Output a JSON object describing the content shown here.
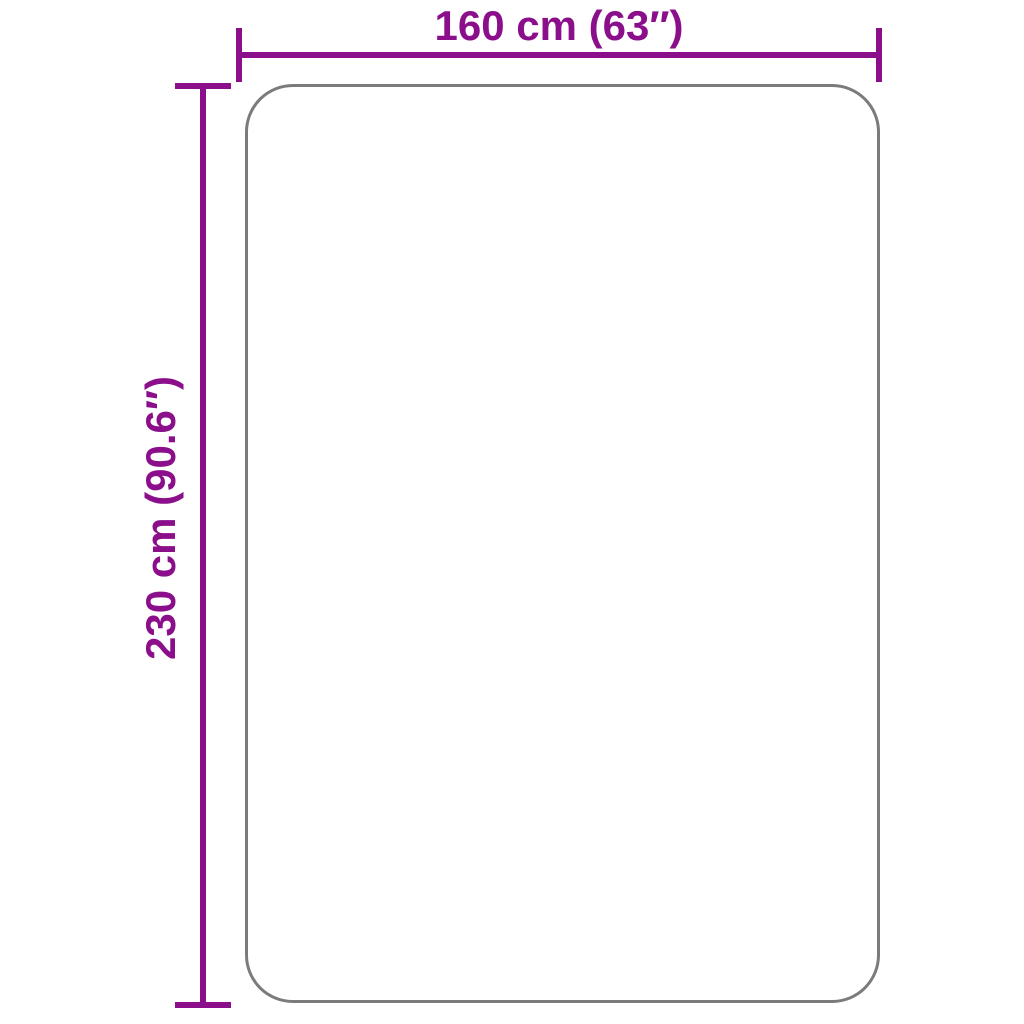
{
  "diagram": {
    "type": "product-dimension-diagram",
    "dimensions": {
      "width": {
        "label": "160 cm (63″)",
        "value_cm": 160,
        "value_inch": 63
      },
      "height": {
        "label": "230 cm (90.6″)",
        "value_cm": 230,
        "value_inch": 90.6
      }
    },
    "colors": {
      "accent": "#8B0E8B",
      "outline": "#7B7B7B",
      "background": "#FFFFFF"
    }
  }
}
